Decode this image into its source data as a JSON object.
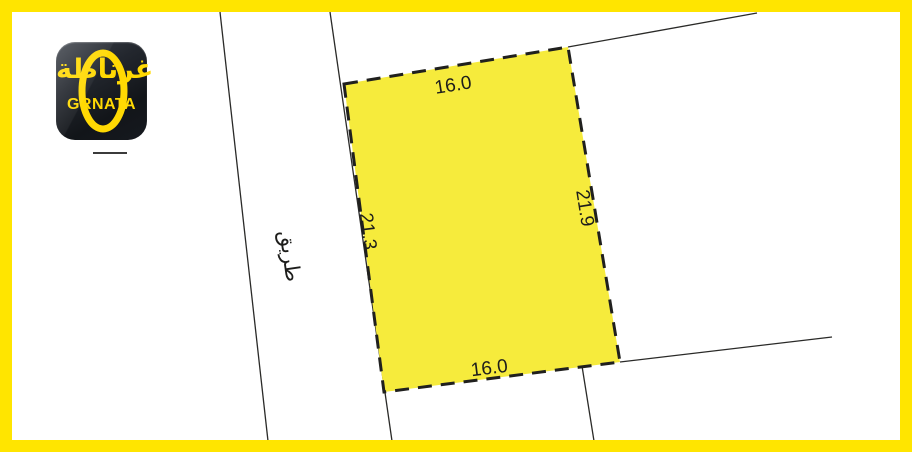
{
  "colors": {
    "frame": "#FFE500",
    "plot_fill": "#F6EB3C",
    "dash": "#20201E",
    "line": "#2A2A28",
    "label": "#1D1D1B",
    "logo_yellow": "#FFD903"
  },
  "logo": {
    "arabic": "غرناطة",
    "latin": "GRNATA"
  },
  "road": {
    "label": "طريق"
  },
  "plot": {
    "dimensions": {
      "top": "16.0",
      "bottom": "16.0",
      "left": "21.3",
      "right": "21.9"
    }
  }
}
